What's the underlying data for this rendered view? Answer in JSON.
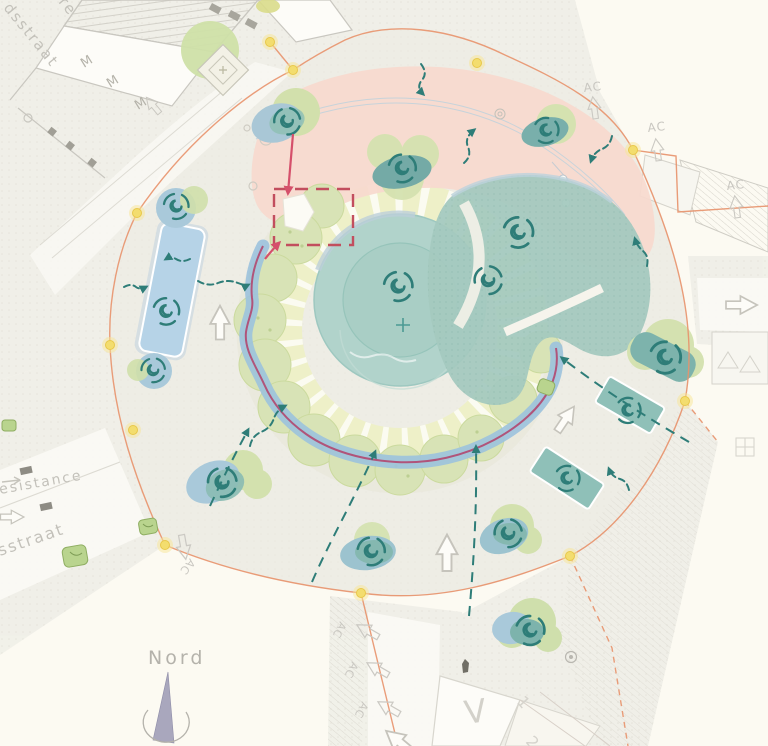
{
  "map": {
    "kind": "roundabout-square landscape masterplan",
    "compass_label": "Nord",
    "streets": {
      "northwest_fragment": "re",
      "northwest": "dsstraat",
      "west_upper": "esistance",
      "west_lower": "sstraat"
    },
    "markers": {
      "ac_label": "AC",
      "building_label": "V",
      "lane_number_1": "1",
      "lane_number_2": "2",
      "building_mark": "M"
    },
    "colors": {
      "background": "#fcfaf2",
      "street": "#efeee7",
      "plaza": "#ecebe2",
      "building_outline": "#c9c7c0",
      "pink_zone": "#f7d9ce",
      "pond_teal": "#b1d3cb",
      "canopy_teal": "#a4c9bf",
      "tree_green": "#d6e2b4",
      "stripe_ring": "#eef0c8",
      "water_blue": "#9cc2dd",
      "route_purple": "#b0547a",
      "annotation_teal": "#2e7d78",
      "highlight_red": "#d5506b",
      "boundary_orange": "#e8926b",
      "node_yellow": "#f3dd6e",
      "text_gray": "#c3c1ba"
    }
  }
}
